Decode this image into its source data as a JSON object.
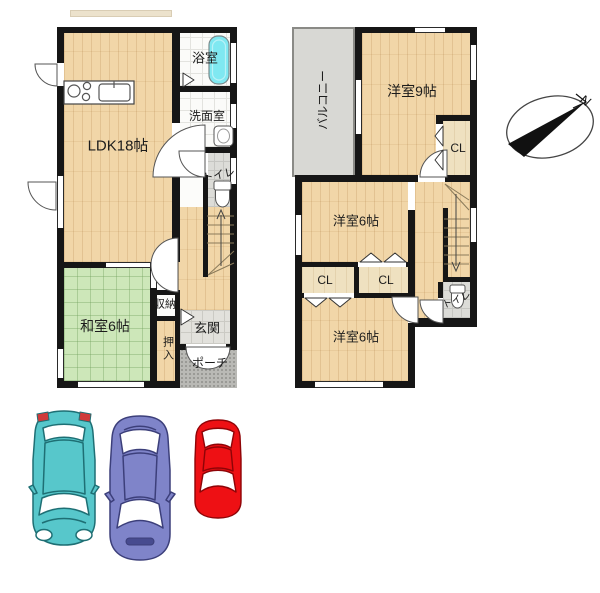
{
  "plan": {
    "floor1": {
      "ldk": "LDK18帖",
      "bath": "浴室",
      "washroom": "洗面室",
      "toilet": "トイレ",
      "japanese_room": "和室6帖",
      "storage": "収納",
      "closet": "押入",
      "entrance": "玄関",
      "porch": "ポーチ"
    },
    "floor2": {
      "balcony": "バルコニー",
      "bedroom9": "洋室9帖",
      "closet_main": "CL",
      "bedroom6_upper": "洋室6帖",
      "closet_left": "CL",
      "closet_right": "CL",
      "bedroom6_lower": "洋室6帖",
      "toilet": "トイレ"
    }
  },
  "compass": {
    "label": "N"
  },
  "cars": [
    {
      "name": "teal-hatchback-top-view",
      "color": "#57C7CB",
      "outline": "#1E6F74"
    },
    {
      "name": "purple-sedan-top-view",
      "color": "#7F84C9",
      "outline": "#3C3F7A"
    },
    {
      "name": "red-compact-top-view",
      "color": "#EE1014",
      "outline": "#8E0407"
    }
  ],
  "colors": {
    "wall": "#161616",
    "wood_floor": "#F1D6A8",
    "tatami": "#CDE7B9",
    "balcony": "#D8D8D4",
    "porch_tile": "#B9B9B5",
    "bath_tub": "#7FE8F1",
    "toilet_tile": "#DCDCD8"
  }
}
